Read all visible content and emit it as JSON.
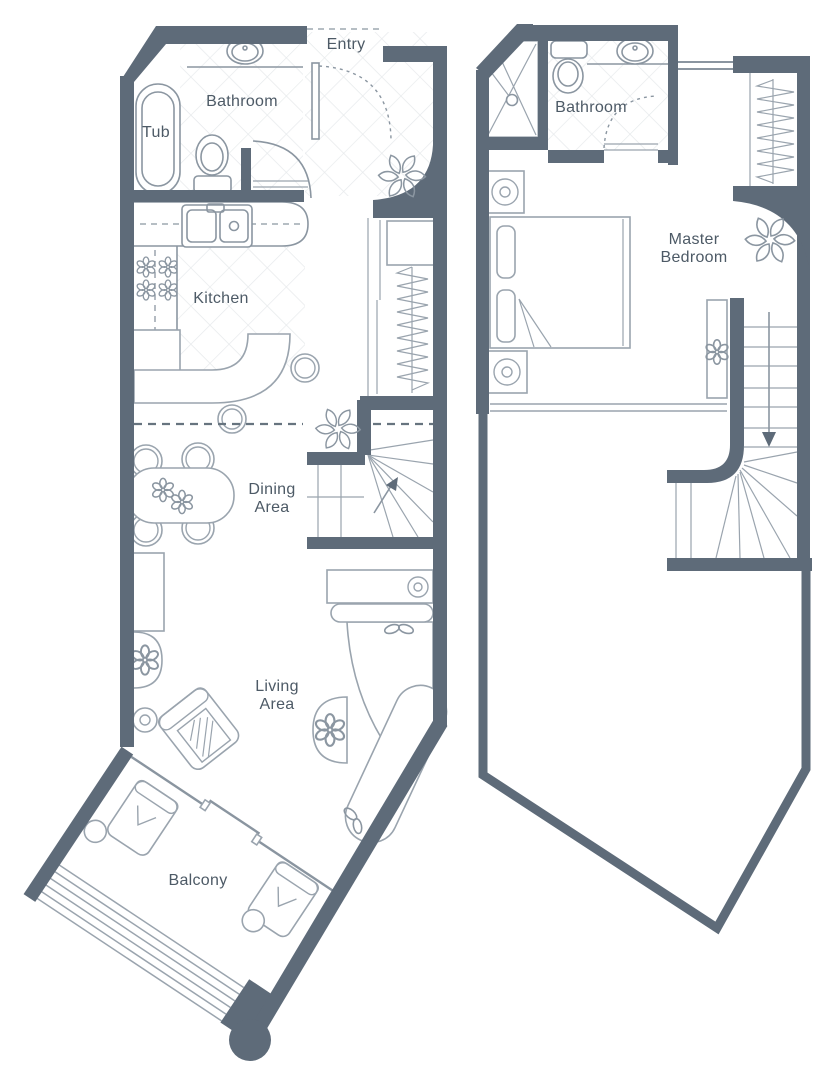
{
  "floor_plans": {
    "lower": {
      "entry_label": "Entry",
      "bathroom_label": "Bathroom",
      "tub_label": "Tub",
      "kitchen_label": "Kitchen",
      "dining_label_line1": "Dining",
      "dining_label_line2": "Area",
      "living_label_line1": "Living",
      "living_label_line2": "Area",
      "balcony_label": "Balcony"
    },
    "upper": {
      "bathroom_label": "Bathroom",
      "master_label_line1": "Master",
      "master_label_line2": "Bedroom"
    }
  },
  "icons": {
    "fan": "fan-icon",
    "plant": "plant-icon",
    "leaf_pair": "leaf-pair-icon"
  },
  "colors": {
    "wall": "#5e6b79",
    "fixture_line": "#8b96a1",
    "furniture_line": "#9aa4ae",
    "tile_line": "#e7eaec",
    "text": "#4d5a66",
    "dash_line": "#67747f",
    "window_line": "#8a95a0",
    "background": "#ffffff"
  }
}
